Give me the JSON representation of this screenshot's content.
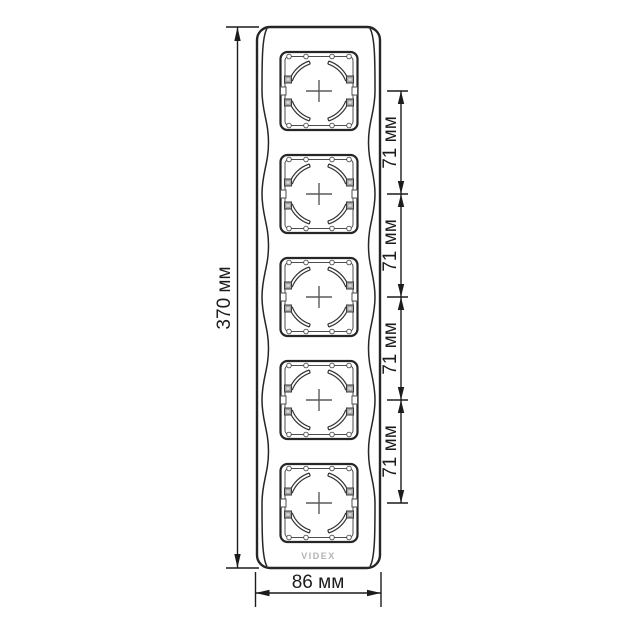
{
  "drawing": {
    "type": "technical-dimension-drawing",
    "subject": "5-gang vertical socket frame",
    "socket_count": 5,
    "dimensions": {
      "height": {
        "label": "370 мм"
      },
      "width": {
        "label": "86 мм"
      },
      "spacing": [
        {
          "label": "71 мм"
        },
        {
          "label": "71 мм"
        },
        {
          "label": "71 мм"
        },
        {
          "label": "71 мм"
        }
      ]
    },
    "logo": "VIDEX",
    "colors": {
      "outline": "#262626",
      "dimension_line": "#1c1c1c",
      "clip_fill": "#a3a3a3",
      "logo_text": "#b3b3b3",
      "background": "#ffffff"
    }
  }
}
